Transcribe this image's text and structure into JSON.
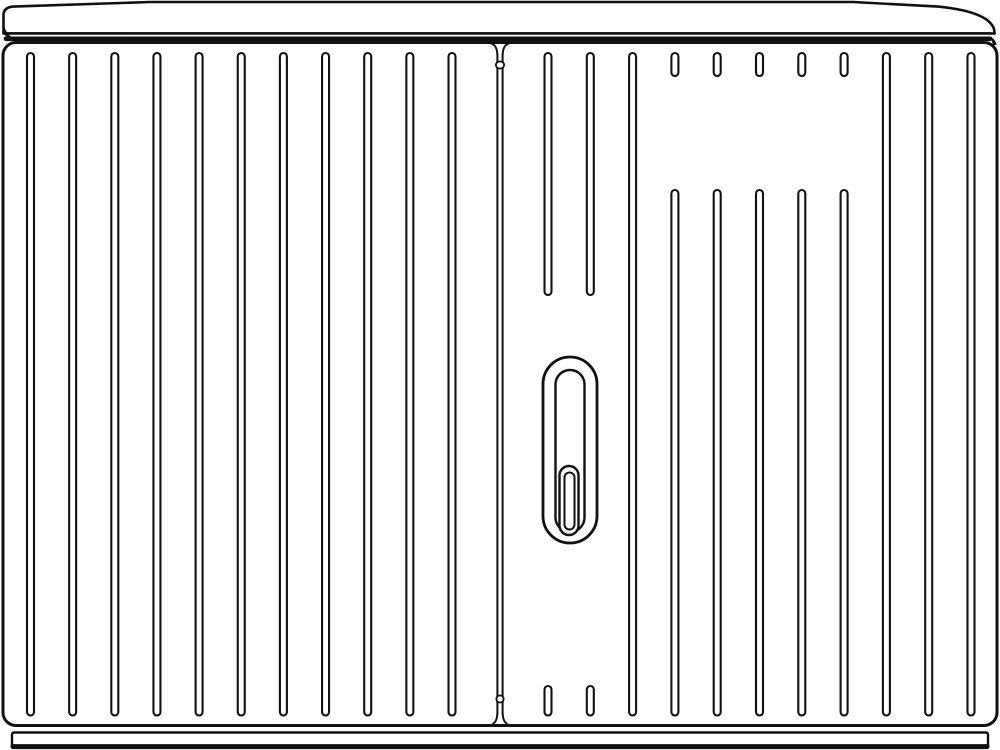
{
  "illustration": {
    "description": "line drawing of a two-door ribbed electrical street cabinet with lid, lock handle and plinth",
    "colors": {
      "background": "#ffffff",
      "line": "#111111",
      "fill": "#ffffff"
    },
    "canvas": {
      "width": 1000,
      "height": 750
    },
    "lid": {
      "outline_path": "M 3.5 33.5 L 3.5 15 Q 3.5 7.6 13 6.6 L 150 2 L 853 2 L 938 6.6 Q 988 11.5 994 29 L 994.6 33.5 Z",
      "left_curl_path": "M 3.5 21 C 4.2 29.5 7.5 35 13.5 37.8 C 8.6 38.1 5.2 36.3 3.2 33.2 Z",
      "stroke": 2.6
    },
    "band": {
      "thin": {
        "x1": 5,
        "x2": 991,
        "y": 33.2,
        "stroke": 2.2
      },
      "thick": {
        "x1": 6,
        "x2": 990,
        "y": 38.8,
        "stroke": 4.6
      },
      "right_curl_path": "M 990 36.6 C 994 38.6 996 41.2 996.6 45 L 993 45 C 992.2 41 991 38.8 988 36.6 Z"
    },
    "body": {
      "x": 3,
      "y": 42.5,
      "w": 994,
      "h": 683,
      "r": 13,
      "stroke": 3
    },
    "seam": {
      "x_left": 497.4,
      "x_right": 502.6,
      "y_top": 54,
      "y_bottom": 714,
      "stroke": 2,
      "flares": [
        "M 491.5 43.8 Q 496.9 45 497.4 55",
        "M 508.5 43.8 Q 503.1 45 502.6 55",
        "M 492.5 723.8 Q 496.9 722.5 497.4 713",
        "M 507.5 723.8 Q 503.1 722.5 502.6 713"
      ],
      "ticks": [
        {
          "x": 495.9,
          "y": 61.5,
          "w": 8.2,
          "h": 7,
          "r": 3.5
        },
        {
          "x": 496.4,
          "y": 695.5,
          "w": 7.2,
          "h": 7,
          "r": 3.3
        }
      ],
      "tick_stroke": 1.8
    },
    "ribs": {
      "width": 7,
      "stroke": 2.1,
      "left_door": {
        "start_x": 30.5,
        "spacing": 42.15,
        "count": 11,
        "segments": [
          [
            53,
            715.5
          ]
        ]
      },
      "right_door": {
        "items": [
          {
            "x": 548.0,
            "segments": [
              [
                53,
                295
              ],
              [
                686,
                715.5
              ]
            ]
          },
          {
            "x": 590.3,
            "segments": [
              [
                53,
                295
              ],
              [
                686,
                715.5
              ]
            ]
          },
          {
            "x": 632.6,
            "segments": [
              [
                53,
                715.5
              ]
            ]
          },
          {
            "x": 674.9,
            "segments": [
              [
                53,
                76
              ],
              [
                190,
                715.5
              ]
            ]
          },
          {
            "x": 717.2,
            "segments": [
              [
                53,
                76
              ],
              [
                190,
                715.5
              ]
            ]
          },
          {
            "x": 759.5,
            "segments": [
              [
                53,
                76
              ],
              [
                190,
                715.5
              ]
            ]
          },
          {
            "x": 801.8,
            "segments": [
              [
                53,
                76
              ],
              [
                190,
                715.5
              ]
            ]
          },
          {
            "x": 844.1,
            "segments": [
              [
                53,
                76
              ],
              [
                190,
                715.5
              ]
            ]
          },
          {
            "x": 886.4,
            "segments": [
              [
                53,
                715.5
              ]
            ]
          },
          {
            "x": 928.7,
            "segments": [
              [
                53,
                715.5
              ]
            ]
          },
          {
            "x": 971.0,
            "segments": [
              [
                53,
                715.5
              ]
            ]
          }
        ]
      }
    },
    "lock": {
      "outer": {
        "x": 543.0,
        "y": 357.0,
        "w": 54,
        "h": 186,
        "r": 27,
        "stroke": 2.8
      },
      "inner": {
        "x": 555.5,
        "y": 370.0,
        "w": 29,
        "h": 162,
        "r": 14.5,
        "stroke": 2.4
      },
      "key_outer": {
        "x": 559.5,
        "y": 466.0,
        "w": 19,
        "h": 69,
        "r": 9.5,
        "stroke": 2.4
      },
      "key_inner": {
        "x": 564.5,
        "y": 472.5,
        "w": 10,
        "h": 57,
        "r": 5,
        "stroke": 2
      }
    },
    "base": {
      "x": 12,
      "y": 732.5,
      "w": 976,
      "h": 14.5,
      "r": 2,
      "stroke": 2.4,
      "bottom_line": {
        "x1": 13,
        "x2": 987,
        "y": 746.6,
        "stroke": 5
      }
    }
  }
}
